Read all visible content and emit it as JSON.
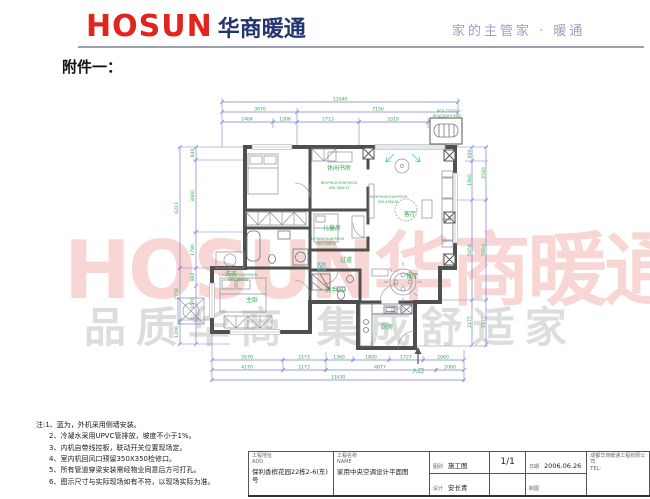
{
  "header": {
    "logo_en": "HOSUN",
    "logo_cn": "华商暖通",
    "slogan": "家的主管家 · 暖通"
  },
  "attachment_label": "附件一：",
  "watermarks": {
    "red": "HOSUN华商暖通",
    "gray": "品质华商 集成舒适家"
  },
  "plan": {
    "rooms": {
      "study": "休闲书房",
      "kids": "儿童房",
      "living": "客厅",
      "dining": "餐厅",
      "kitchen": "厨房",
      "bath": "洗手间",
      "master": "主卧",
      "corridor": "过道",
      "laundry": "洗衣",
      "entry": "入口"
    },
    "units": {
      "study_spec": "600*900*200*MOD",
      "study_model": "KM-36W-D",
      "kids_spec": "740*900*200*MOD",
      "kids_model": "KM-25W-D",
      "living_spec": "2000*900*200*MOD",
      "living_model": "KM-45W-D",
      "master_spec": "1200*900*200*MOD",
      "master_model": "KM-28W-D",
      "outdoor_model": "KFR-72S2S",
      "outdoor_spec": "600*300*(350)"
    },
    "dims": {
      "top_total": "11040",
      "top_row2": [
        "3670",
        "7150"
      ],
      "top_row3": [
        "2464",
        "1206",
        "2713",
        "3319",
        "700"
      ],
      "bottom_row1": [
        "3570",
        "2173",
        "1360",
        "1800",
        "1727",
        "2060"
      ],
      "bottom_row2": [
        "4170",
        "2173",
        "4877",
        "2060"
      ],
      "bottom_total": "13430",
      "left_inner": [
        "640",
        "3660",
        "1790",
        "962",
        "1676"
      ],
      "left_outer": [
        "6213",
        "2750",
        "1200"
      ],
      "right_inner": [
        "600",
        "1940",
        "5656",
        "2175"
      ],
      "right_outer": [
        "2540",
        "5686",
        "2175"
      ]
    }
  },
  "notes": {
    "lines": [
      "注:1、蓝为，外机采用侧墙安装。",
      "2、冷凝水采用UPVC管排放，坡度不小于1%。",
      "3、内机自带线控板，联动开关位置现场定。",
      "4、室内机回风口预留350X350检修口。",
      "5、所有管道穿梁安装需经物业同意后方可打孔。",
      "6、图示尺寸与实际现场如有不符，以现场实际为准。"
    ]
  },
  "title_block": {
    "address_label": "工程地址",
    "address_label_en": "ADD.",
    "address": "保利香槟花园22栋2-6(东)号",
    "name_label": "工程名称",
    "name_label_en": "NAME",
    "name": "家用中央空调设计平面图",
    "category_label": "图别",
    "category": "施工图",
    "designer_label": "设计",
    "designer": "安长青",
    "page": "1/1",
    "date_label": "日期",
    "date": "2006.06.26",
    "draft_label": "制图",
    "company_line1": "成都华商暖通工程有限公司",
    "company_line2": "TEL:"
  }
}
